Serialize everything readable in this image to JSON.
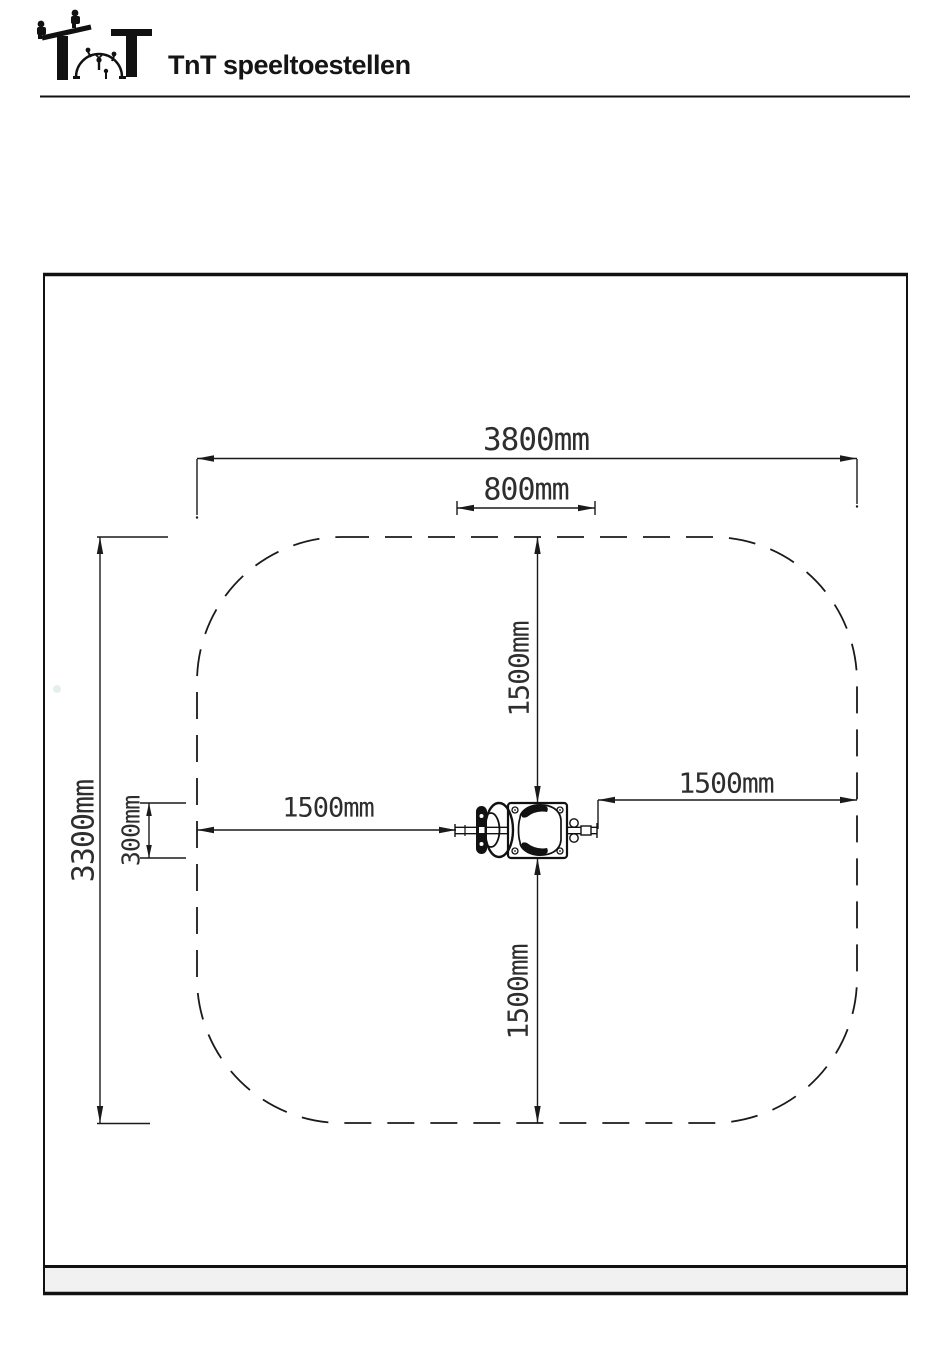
{
  "header": {
    "brand": "TnT speeltoestellen",
    "logo": "tnt-playground-logo"
  },
  "drawing": {
    "type": "top-view installation / safety-zone plan of a spring rider",
    "dims": {
      "total_width": "3800mm",
      "device_width": "800mm",
      "total_height": "3300mm",
      "device_depth": "300mm",
      "clearance_top": "1500mm",
      "clearance_left": "1500mm",
      "clearance_right": "1500mm",
      "clearance_bottom": "1500mm"
    },
    "colors": {
      "line": "#1a1a1a",
      "footer_band": "#f1f1f1",
      "paper": "#ffffff"
    }
  }
}
